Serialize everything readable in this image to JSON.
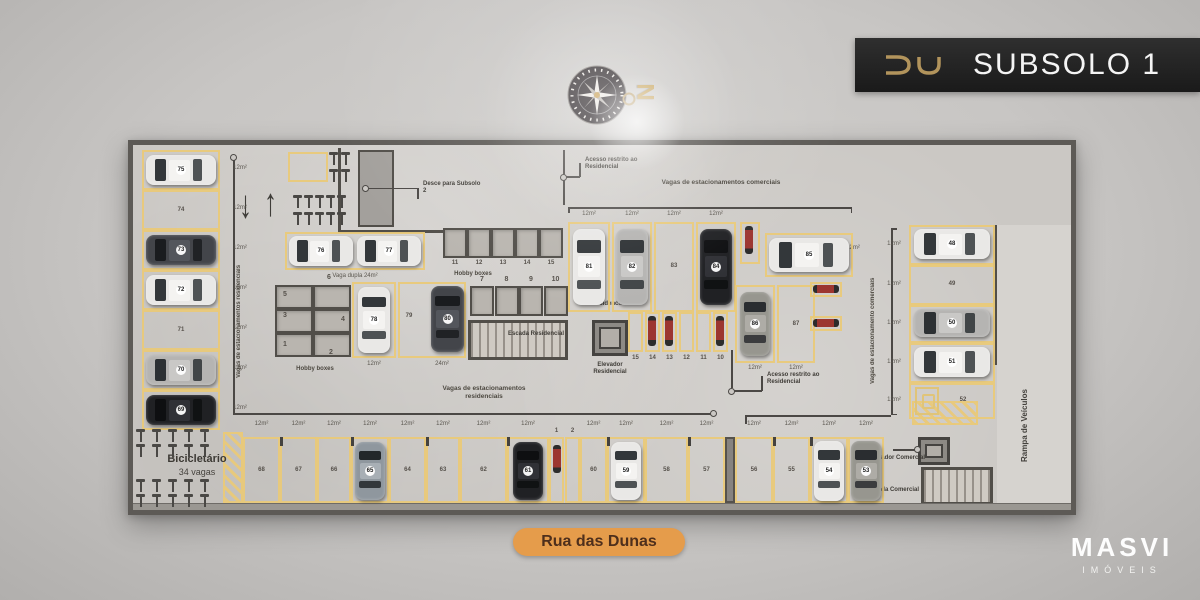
{
  "banner": {
    "logo": "DU",
    "title": "SUBSOLO 1"
  },
  "compass": {
    "north": "N"
  },
  "street": "Rua das Dunas",
  "brand": {
    "name": "MASVI",
    "tagline": "IMÓVEIS"
  },
  "legend": {
    "bicicletario_title": "Bicicletário",
    "bicicletario_count": "34 vagas",
    "rampa": "Rampa de Veículos",
    "sobe": "Sobe para o térreo",
    "residencial_corridor": "Vagas de estacionamentos residenciais",
    "residencial_area": "Vagas de estacionamentos residenciais",
    "comercial_top": "Vagas de estacionamentos comerciais",
    "comercial_right": "Vagas de estacionamento comerciais",
    "desce": "Desce para Subsolo 2",
    "acesso_restrito": "Acesso restrito ao Residencial",
    "vaga_dupla": "Vaga dupla 24m²",
    "hobby_boxes": "Hobby boxes",
    "hall": "Hall Residencial",
    "elevador_residencial": "Elevador Residencial",
    "escada_residencial": "Escada Residencial",
    "elevador_comercial": "Elevador Comercial",
    "escada_comercial": "Escada Comercial",
    "size12": "12m²",
    "size24": "24m²"
  },
  "spaces": {
    "left_column": [
      {
        "num": "75",
        "car": "white"
      },
      {
        "num": "74"
      },
      {
        "num": "73",
        "car": "dark"
      },
      {
        "num": "72",
        "car": "white"
      },
      {
        "num": "71"
      },
      {
        "num": "70",
        "car": "silver"
      },
      {
        "num": "69",
        "car": "black"
      }
    ],
    "bottom_left": [
      {
        "num": "68"
      },
      {
        "num": "67"
      },
      {
        "num": "66"
      },
      {
        "num": "65",
        "car": "steel"
      },
      {
        "num": "64"
      },
      {
        "num": "63"
      },
      {
        "num": "62"
      },
      {
        "num": "61",
        "car": "black"
      },
      {
        "num": "60"
      },
      {
        "num": "59",
        "car": "white"
      },
      {
        "num": "58"
      },
      {
        "num": "57"
      }
    ],
    "bottom_right": [
      {
        "num": "56"
      },
      {
        "num": "55"
      },
      {
        "num": "54",
        "car": "white"
      },
      {
        "num": "53",
        "car": "grey"
      }
    ],
    "top_commercial": [
      {
        "num": "81",
        "car": "white"
      },
      {
        "num": "82",
        "car": "silver"
      },
      {
        "num": "83"
      },
      {
        "num": "84",
        "car": "black"
      }
    ],
    "space85": {
      "num": "85",
      "car": "white"
    },
    "mid_commercial": [
      {
        "num": "86",
        "car": "grey"
      },
      {
        "num": "87"
      }
    ],
    "right_column": [
      {
        "num": "48",
        "car": "white"
      },
      {
        "num": "49"
      },
      {
        "num": "50",
        "car": "silver"
      },
      {
        "num": "51",
        "car": "white"
      },
      {
        "num": "52",
        "accessible": true
      }
    ],
    "vaga_dupla_cars": [
      {
        "num": "76"
      },
      {
        "num": "77"
      }
    ],
    "space78": {
      "num": "78",
      "car": "white"
    },
    "space79": {
      "num": "79"
    },
    "space80": {
      "num": "80",
      "car": "dark"
    },
    "moto_row": [
      "15",
      "14",
      "13",
      "12",
      "11",
      "10"
    ],
    "moto_bottom": [
      "1",
      "2"
    ],
    "hobby_left": [
      "1",
      "2",
      "3",
      "4",
      "5",
      "6"
    ],
    "hobby_mid": [
      "11",
      "12",
      "13",
      "14",
      "15"
    ],
    "hobby_right": [
      "7",
      "8",
      "9",
      "10"
    ]
  },
  "colors": {
    "accent_yellow": "#e9c979",
    "banner_bg": "#1f1f1f",
    "gold": "#b2945c",
    "street_pill": "#e59c4b"
  }
}
